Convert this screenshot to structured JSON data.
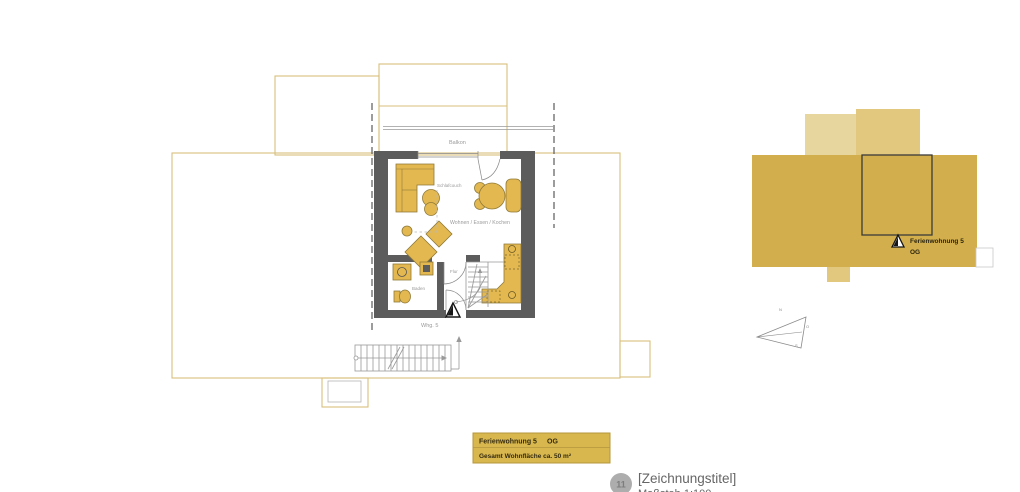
{
  "colors": {
    "building_outline": "#D8BF7B",
    "wall": "#5C5C5C",
    "furniture": "#E3B851",
    "site_gold": "#D2AF4C",
    "site_pale": "#E8D69F",
    "site_pale_dark": "#E2C87E",
    "title_block": "#D8B84E"
  },
  "plan": {
    "labels": {
      "balkon": "Balkon",
      "schlafcouch": "Schlafcouch",
      "wohnen": "Wohnen / Essen / Kochen",
      "flur": "Flur",
      "baden": "Baden",
      "whg": "Whg. 5"
    }
  },
  "site_plan": {
    "label_line1": "Ferienwohnung 5",
    "label_line2": "OG"
  },
  "compass": {
    "top": "N",
    "right": "O",
    "bottom": "S"
  },
  "title_block": {
    "line1_left": "Ferienwohnung 5",
    "line1_right": "OG",
    "line2": "Gesamt Wohnfläche ca. 50 m²"
  },
  "footer": {
    "sheet_number": "11",
    "drawing_title": "[Zeichnungstitel]",
    "scale": "Maßstab 1:100"
  }
}
